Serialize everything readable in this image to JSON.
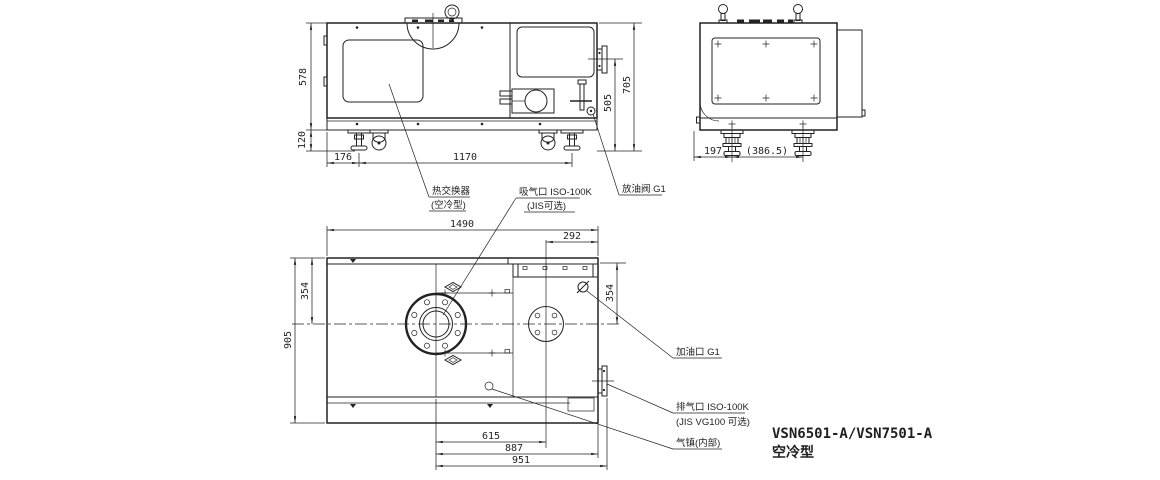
{
  "drawing": {
    "model": "VSN6501-A/VSN7501-A",
    "variant": "空冷型"
  },
  "side_view": {
    "dim_body_height": "578",
    "dim_base_height": "120",
    "dim_foot_offset": "176",
    "dim_foot_span": "1170",
    "dim_exhaust_center_height": "505",
    "dim_overall_height": "705"
  },
  "end_view": {
    "dim_foot_offset": "197",
    "dim_foot_span": "(386.5)"
  },
  "plan_view": {
    "dim_overall_length": "1490",
    "dim_right_offset": "292",
    "dim_left_top_to_center": "354",
    "dim_overall_width": "905",
    "dim_right_top_to_center": "354",
    "dim_flange_to_coupling": "615",
    "dim_flange_to_body_end": "887",
    "dim_flange_to_exhaust_face": "951"
  },
  "callouts": {
    "heat_exchanger_line1": "热交换器",
    "heat_exchanger_line2": "(空冷型)",
    "intake_line1": "吸气口 ISO-100K",
    "intake_line2": "(JIS可选)",
    "oil_drain": "放油阀 G1",
    "oil_fill": "加油口 G1",
    "exhaust_line1": "排气口 ISO-100K",
    "exhaust_line2": "(JIS VG100 可选)",
    "gas_ballast": "气镇(内部)"
  }
}
